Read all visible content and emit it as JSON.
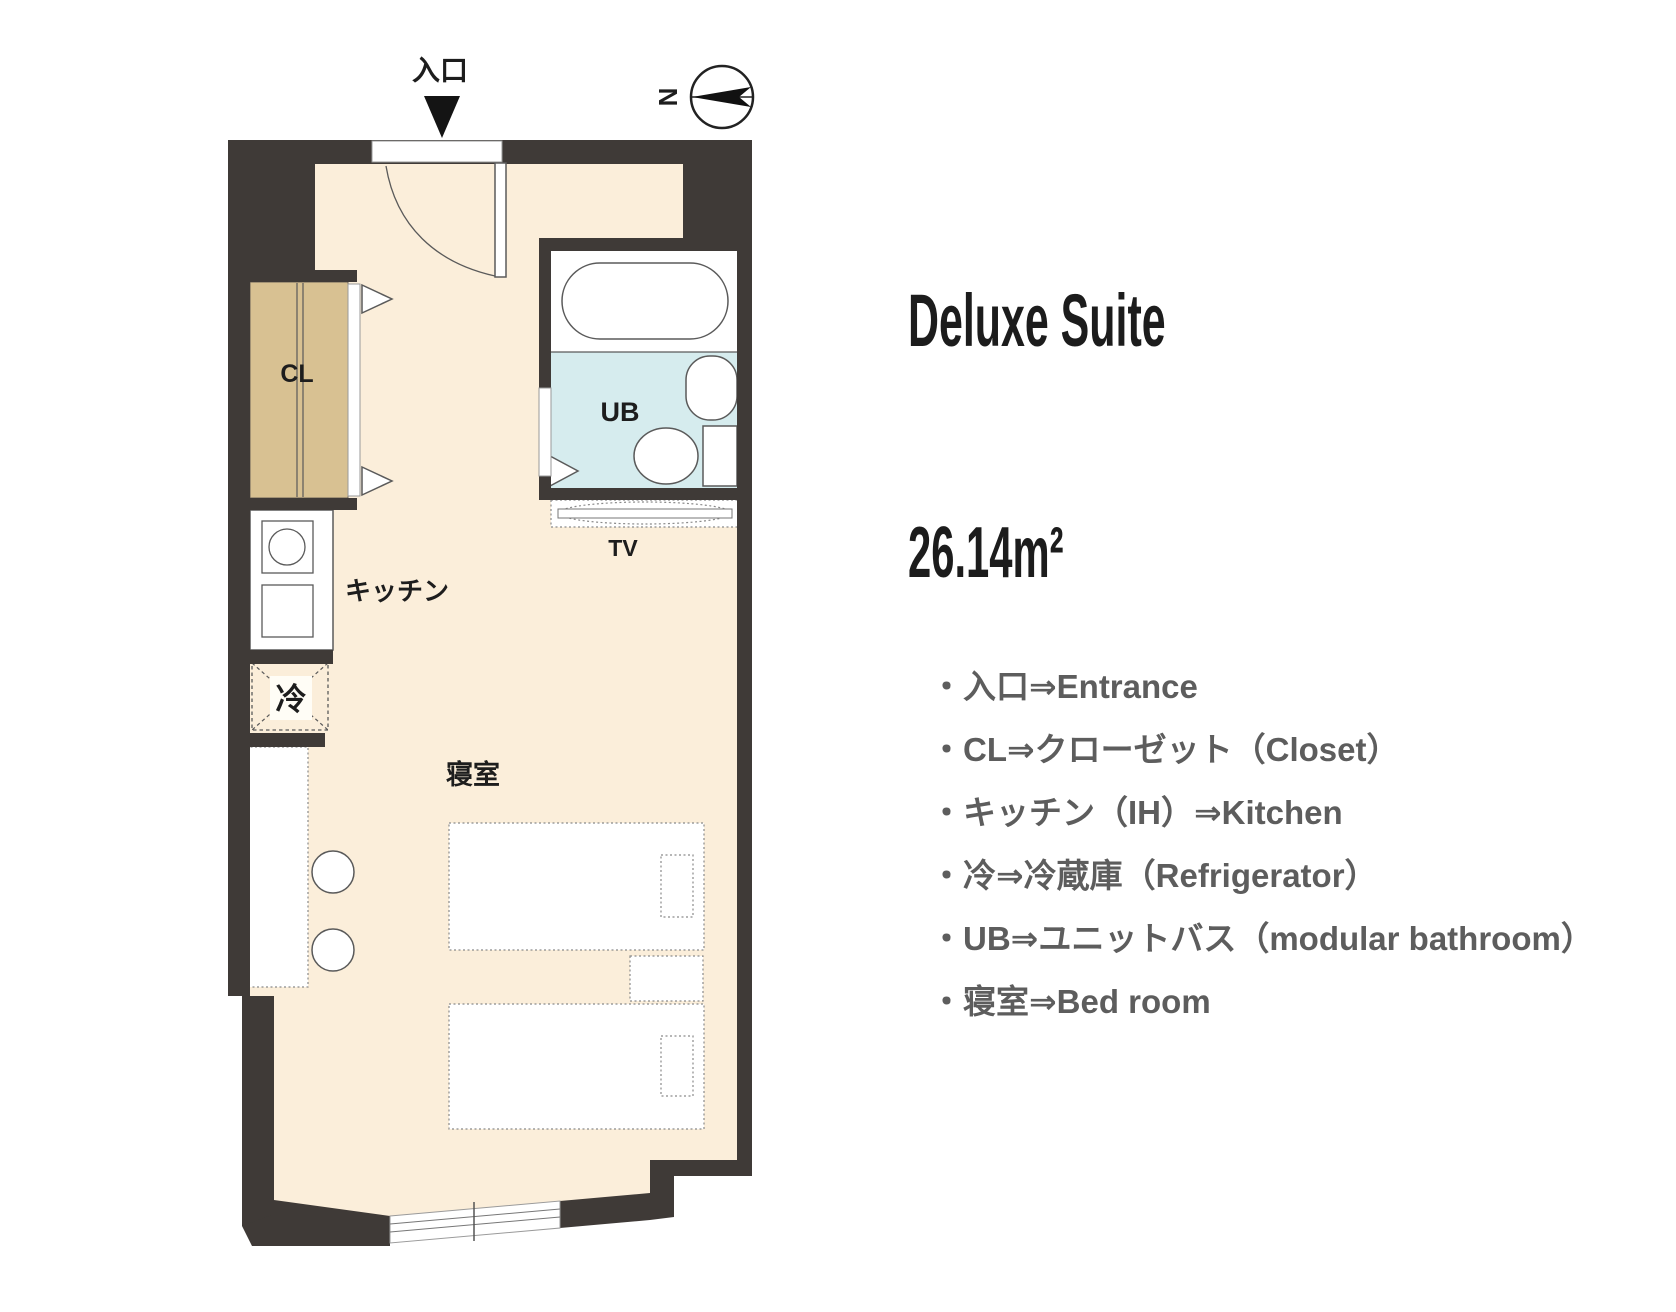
{
  "panel": {
    "title": "Deluxe Suite",
    "area": "26.14m²"
  },
  "legend": {
    "items": [
      {
        "text": "・入口⇒Entrance"
      },
      {
        "text": "・CL⇒クローゼット（Closet）"
      },
      {
        "text": "・キッチン（IH）⇒Kitchen"
      },
      {
        "text": "・冷⇒冷蔵庫（Refrigerator）"
      },
      {
        "text": "・UB⇒ユニットバス（modular bathroom）"
      },
      {
        "text": "・寝室⇒Bed room"
      }
    ]
  },
  "floor_plan": {
    "entrance_label": "入口",
    "compass_label": "N",
    "labels": {
      "closet": "CL",
      "bath": "UB",
      "tv": "TV",
      "kitchen": "キッチン",
      "refrigerator": "冷",
      "bedroom": "寝室"
    }
  },
  "colors": {
    "wall": "#3f3a37",
    "floor": "#fbeeda",
    "closet": "#d8c192",
    "bath": "#d6ecee",
    "title_text": "#1c1c1c",
    "legend_text": "#5d5d5d"
  }
}
